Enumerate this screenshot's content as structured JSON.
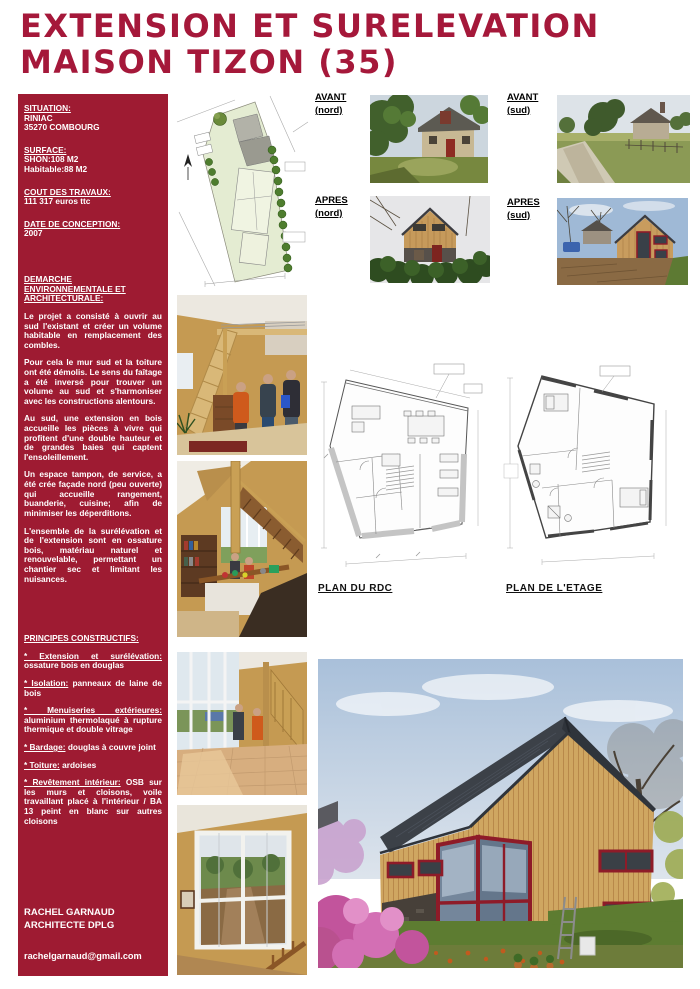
{
  "page": {
    "title_line1": "EXTENSION ET SURELEVATION",
    "title_line2": "MAISON TIZON (35)"
  },
  "colors": {
    "sidebar_red": "#9e1b32",
    "title_red": "#a5183a",
    "window_frame_red": "#8e1b28",
    "timber": "#cfa661",
    "slate_roof": "#3c4148"
  },
  "sidebar": {
    "situation": {
      "label": "SITUATION:",
      "lines": [
        "RINIAC",
        "35270 COMBOURG"
      ]
    },
    "surface": {
      "label": "SURFACE:",
      "lines": [
        "SHON:108 M2",
        "Habitable:88 M2"
      ]
    },
    "travaux": {
      "label": "COUT DES TRAVAUX:",
      "lines": [
        "111 317 euros ttc"
      ]
    },
    "conception": {
      "label": "DATE DE CONCEPTION:",
      "lines": [
        "2007"
      ]
    },
    "demarche": {
      "label": "DEMARCHE ENVIRONNEMENTALE ET ARCHITECTURALE:",
      "paragraphs": [
        "Le projet a consisté à ouvrir au sud l'existant et créer un volume habitable en remplacement des combles.",
        "Pour cela le mur sud et la toiture ont été démolis. Le sens du faîtage a été inversé pour trouver un volume au sud et s'harmoniser avec les constructions alentours.",
        "Au sud, une extension en bois accueille les pièces à vivre qui profitent d'une double hauteur et de grandes baies qui captent l'ensoleillement.",
        "Un espace tampon, de service, a été crée façade nord (peu ouverte) qui accueille rangement, buanderie, cuisine; afin de minimiser les déperditions.",
        "L'ensemble de la surélévation et de l'extension sont en ossature bois, matériau naturel et renouvelable, permettant un chantier sec et limitant les nuisances."
      ]
    },
    "principes": {
      "label": "PRINCIPES CONSTRUCTIFS:",
      "items": [
        {
          "term": "* Extension et surélévation:",
          "desc": "ossature bois en douglas"
        },
        {
          "term": "* Isolation:",
          "desc": "panneaux de laine de bois"
        },
        {
          "term": "* Menuiseries extérieures:",
          "desc": "aluminium thermolaqué à rupture thermique et double vitrage"
        },
        {
          "term": "* Bardage:",
          "desc": "douglas à couvre joint"
        },
        {
          "term": "* Toiture:",
          "desc": "ardoises"
        },
        {
          "term": "* Revêtement intérieur:",
          "desc": "OSB sur les murs et cloisons, voile travaillant placé à l'intérieur / BA 13 peint en blanc sur autres cloisons"
        }
      ]
    },
    "signature_line1": "RACHEL GARNAUD",
    "signature_line2": "ARCHITECTE DPLG",
    "email": "rachelgarnaud@gmail.com"
  },
  "photo_labels": {
    "avant_nord": {
      "title": "AVANT",
      "sub": "(nord)"
    },
    "avant_sud": {
      "title": "AVANT",
      "sub": "(sud)"
    },
    "apres_nord": {
      "title": "APRES",
      "sub": "(nord)"
    },
    "apres_sud": {
      "title": "APRES",
      "sub": "(sud)"
    }
  },
  "plans": {
    "rdc_label": "PLAN DU RDC",
    "etage_label": "PLAN DE L'ETAGE"
  }
}
